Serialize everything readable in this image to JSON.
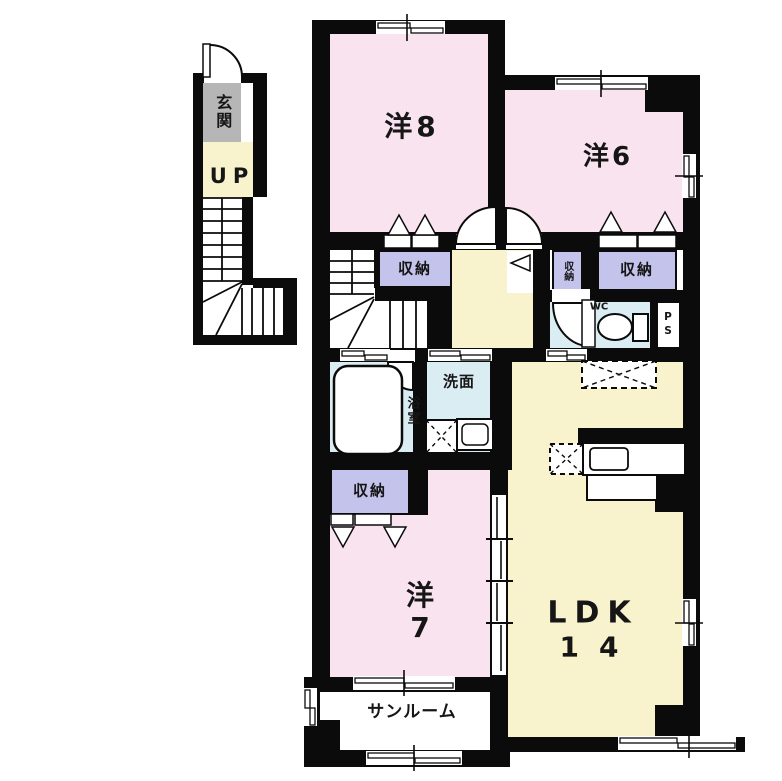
{
  "colors": {
    "wall": "#0b0b0b",
    "pink": "#f9e3ee",
    "cream": "#f8f2cd",
    "blue": "#d9edf2",
    "purple": "#c4c3eb",
    "gray": "#b6b6b6",
    "white": "#ffffff"
  },
  "labels": {
    "genkan": "玄関",
    "up": "UP",
    "room8": "洋8",
    "room6": "洋6",
    "room7_line1": "洋",
    "room7_line2": "7",
    "storage": "収納",
    "wc": "WC",
    "ps": "PS",
    "washroom": "洗面",
    "bathroom": "浴室",
    "ldk_line1": "LDK",
    "ldk_line2": "14",
    "sunroom": "サンルーム"
  }
}
